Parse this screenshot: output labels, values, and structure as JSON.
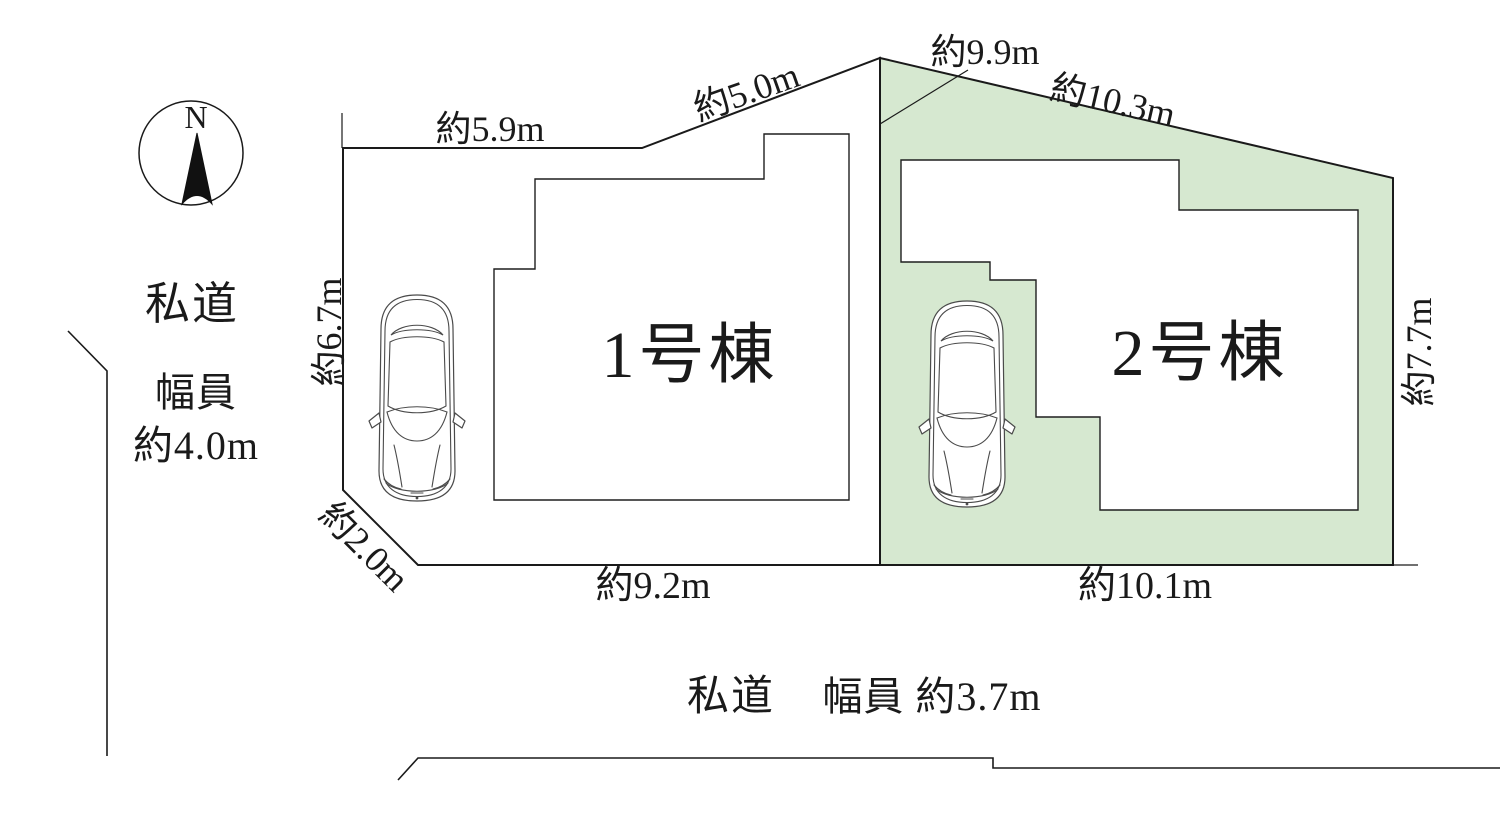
{
  "plan": {
    "compass": {
      "north_label": "N"
    },
    "left_road": {
      "name": "私道",
      "width_label": "幅員",
      "width_value": "約4.0m"
    },
    "bottom_road": {
      "name": "私道",
      "width_text": "幅員 約3.7m"
    },
    "lot1": {
      "label": "1号棟",
      "dims": {
        "top": "約5.9m",
        "top_slant": "約5.0m",
        "left": "約6.7m",
        "corner_slant": "約2.0m",
        "bottom": "約9.2m"
      }
    },
    "lot2": {
      "label": "2号棟",
      "fill": "#d6e8d0",
      "dims": {
        "left_boundary": "約9.9m",
        "top_slant": "約10.3m",
        "right": "約7.7m",
        "bottom": "約10.1m"
      }
    }
  }
}
